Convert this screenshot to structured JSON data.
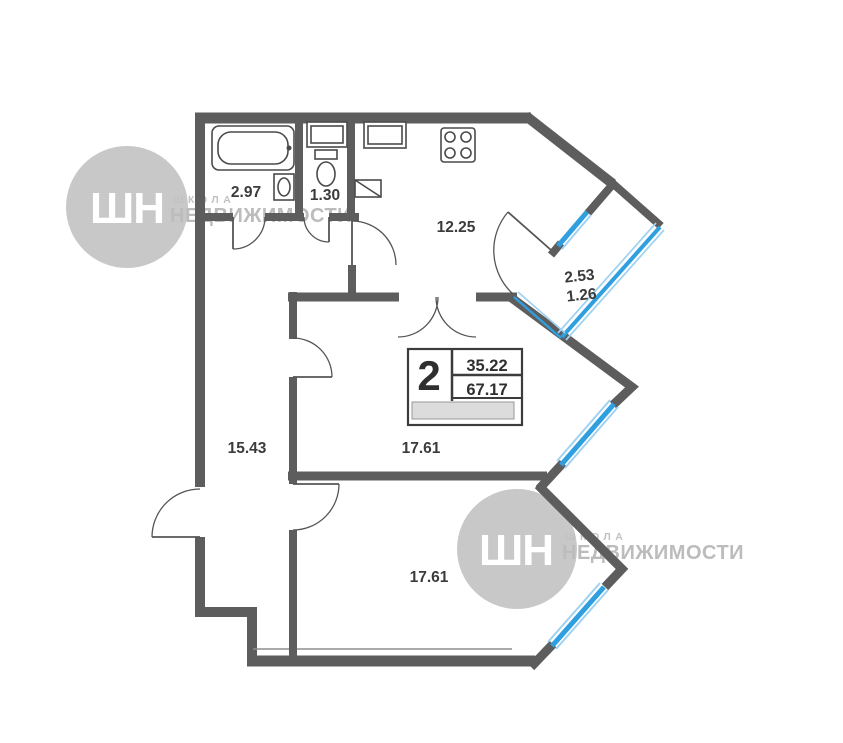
{
  "watermark": {
    "logo_text": "ШН",
    "school": "ШКОЛА",
    "brand": "НЕДВИЖИМОСТИ"
  },
  "info_box": {
    "rooms_count": "2",
    "living_area": "35.22",
    "total_area": "67.17"
  },
  "rooms": [
    {
      "name": "bathroom",
      "area": "2.97"
    },
    {
      "name": "toilet",
      "area": "1.30"
    },
    {
      "name": "kitchen",
      "area": "12.25"
    },
    {
      "name": "balcony",
      "area": "2.53",
      "area_reduced": "1.26"
    },
    {
      "name": "hallway",
      "area": "15.43"
    },
    {
      "name": "living-room-1",
      "area": "17.61"
    },
    {
      "name": "living-room-2",
      "area": "17.61"
    }
  ],
  "colors": {
    "wall": "#5d5d5d",
    "window_glass": "#2f9fe0",
    "window_glass_light": "#9fd2f1",
    "label_text": "#3b3b3b",
    "watermark_gray": "#c6c6c6",
    "info_band": "#dcdcdc"
  }
}
